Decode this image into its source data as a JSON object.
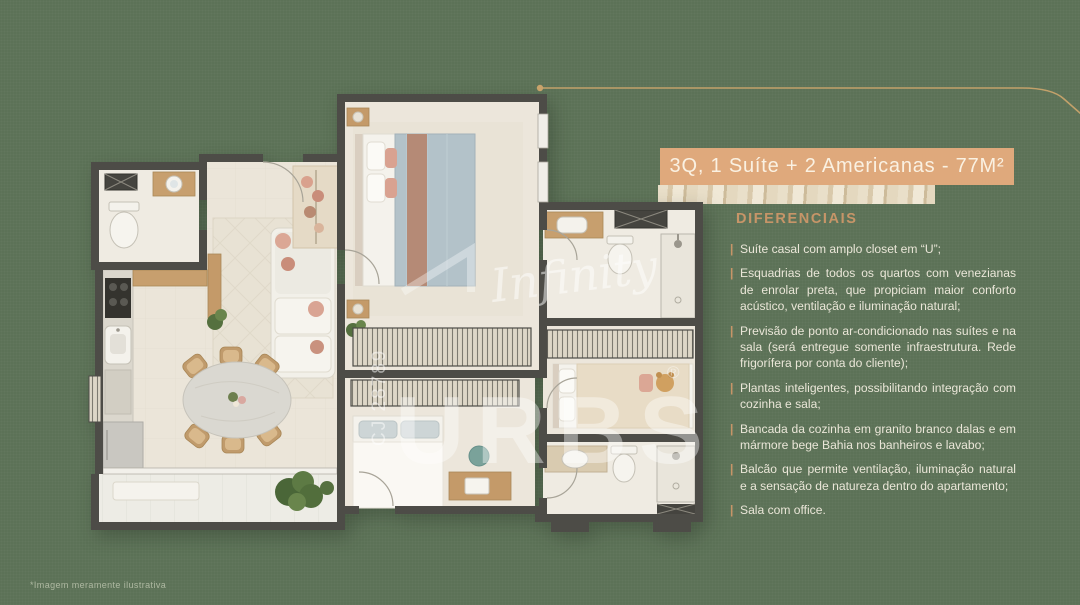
{
  "page": {
    "background_color": "#5c7257",
    "footnote": "*Imagem meramente ilustrativa"
  },
  "banner": {
    "title": "3Q, 1 Suíte + 2 Americanas - 77M²",
    "bg_color": "#dfa97c",
    "text_color": "#faf1e2",
    "leader_line_color": "#c8a36b"
  },
  "details": {
    "heading": "DIFERENCIAIS",
    "heading_color": "#c79568",
    "marker": "|",
    "items": [
      "Suíte casal com amplo closet em “U”;",
      "Esquadrias de todos os quartos com venezianas de enrolar preta, que propiciam maior conforto acústico, ventilação e iluminação natural;",
      "Previsão de ponto ar-condicionado nas suítes e na sala (será entregue somente infraestrutura. Rede frigorífera por conta do cliente);",
      "Plantas inteligentes, possibilitando integração com cozinha e sala;",
      "Bancada da cozinha em granito branco dalas e em mármore bege Bahia nos banheiros e lavabo;",
      "Balcão que permite ventilação, iluminação natural e a sensação de natureza dentro do apartamento;",
      "Sala com office."
    ]
  },
  "floorplan": {
    "wall_color": "#4d4c47",
    "floor_color": "#ebe5d9",
    "watermark": {
      "script": "Infinity",
      "brand": "URBS",
      "registered": "®",
      "registration": "CJ 28789"
    }
  }
}
